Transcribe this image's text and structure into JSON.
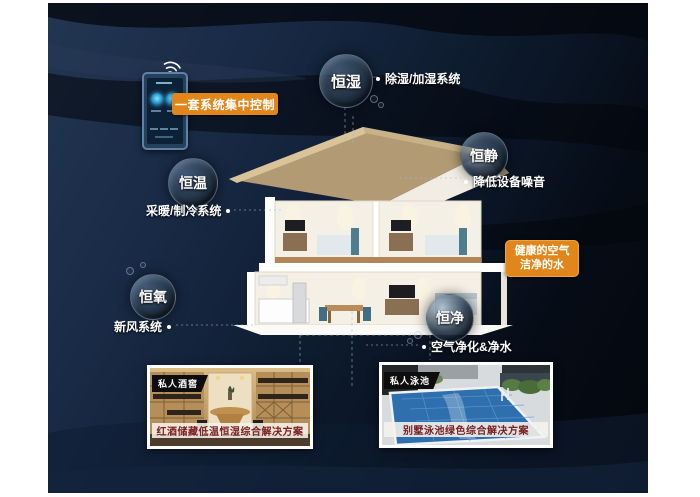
{
  "colors": {
    "accent_orange": "#e1861b",
    "caption_red": "#7a2020",
    "background_navy": "#16263e"
  },
  "control": {
    "label": "一套系统集中控制"
  },
  "bubbles": {
    "humidity": {
      "label": "恒湿"
    },
    "quiet": {
      "label": "恒静"
    },
    "temperature": {
      "label": "恒温"
    },
    "oxygen": {
      "label": "恒氧"
    },
    "purity": {
      "label": "恒净"
    }
  },
  "features": {
    "humidity_system": {
      "label": "除湿/加湿系统"
    },
    "noise_reduction": {
      "label": "降低设备噪音"
    },
    "hvac": {
      "label": "采暖/制冷系统"
    },
    "fresh_air": {
      "label": "新风系统"
    },
    "purification": {
      "label": "空气净化&净水"
    }
  },
  "highlight": {
    "line1": "健康的空气",
    "line2": "洁净的水"
  },
  "cards": {
    "wine": {
      "badge": "私人酒窖",
      "caption": "红酒储藏低温恒湿综合解决方案"
    },
    "pool": {
      "badge": "私人泳池",
      "caption": "别墅泳池绿色综合解决方案"
    }
  }
}
